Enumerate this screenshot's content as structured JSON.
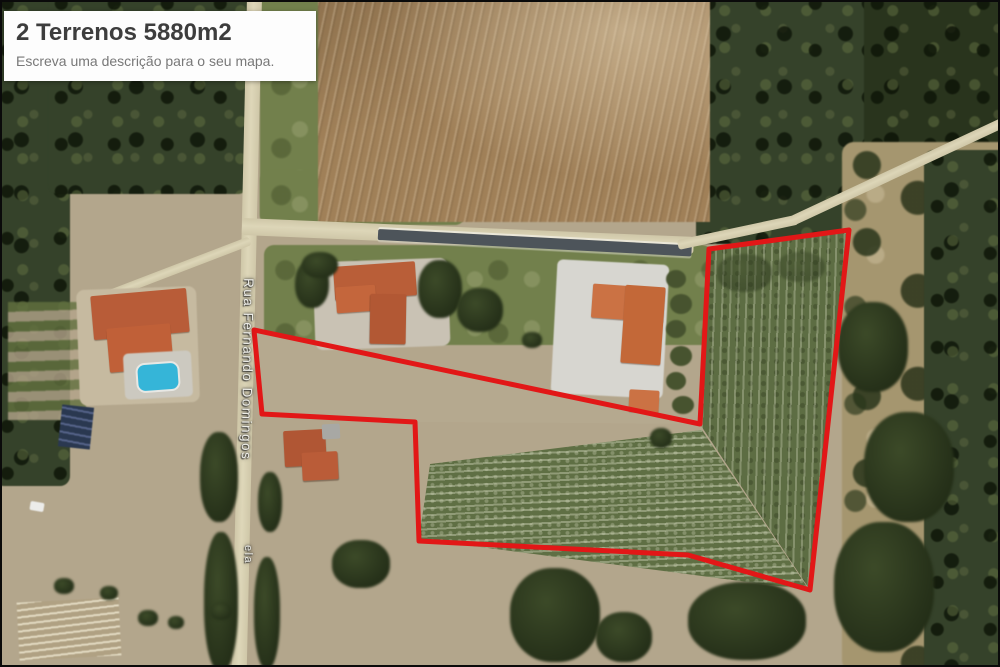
{
  "title_card": {
    "title": "2 Terrenos 5880m2",
    "description": "Escreva uma descrição para o seu mapa."
  },
  "map": {
    "road_label_primary": "Rua Fernando Domingos",
    "road_label_secondary": "ela",
    "parcel": {
      "outline_color": "#e21717",
      "points": "252,328 698,422 707,247 847,228 808,588 686,553 417,539 413,420 260,412"
    }
  }
}
